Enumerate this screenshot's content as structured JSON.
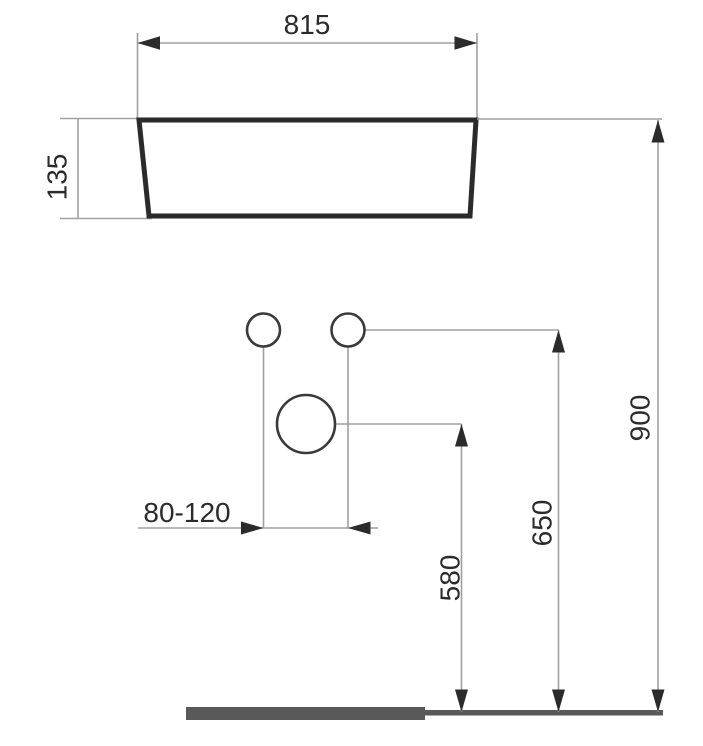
{
  "diagram": {
    "labels": {
      "basin_width": "815",
      "basin_height": "135",
      "hole_spacing": "80-120",
      "height_580": "580",
      "height_650": "650",
      "height_900": "900"
    },
    "colors": {
      "outline": "#2b2b2b",
      "dimension_line": "#a0a0a0",
      "arrow": "#2b2b2b",
      "floor": "#595959",
      "background": "#ffffff"
    }
  }
}
